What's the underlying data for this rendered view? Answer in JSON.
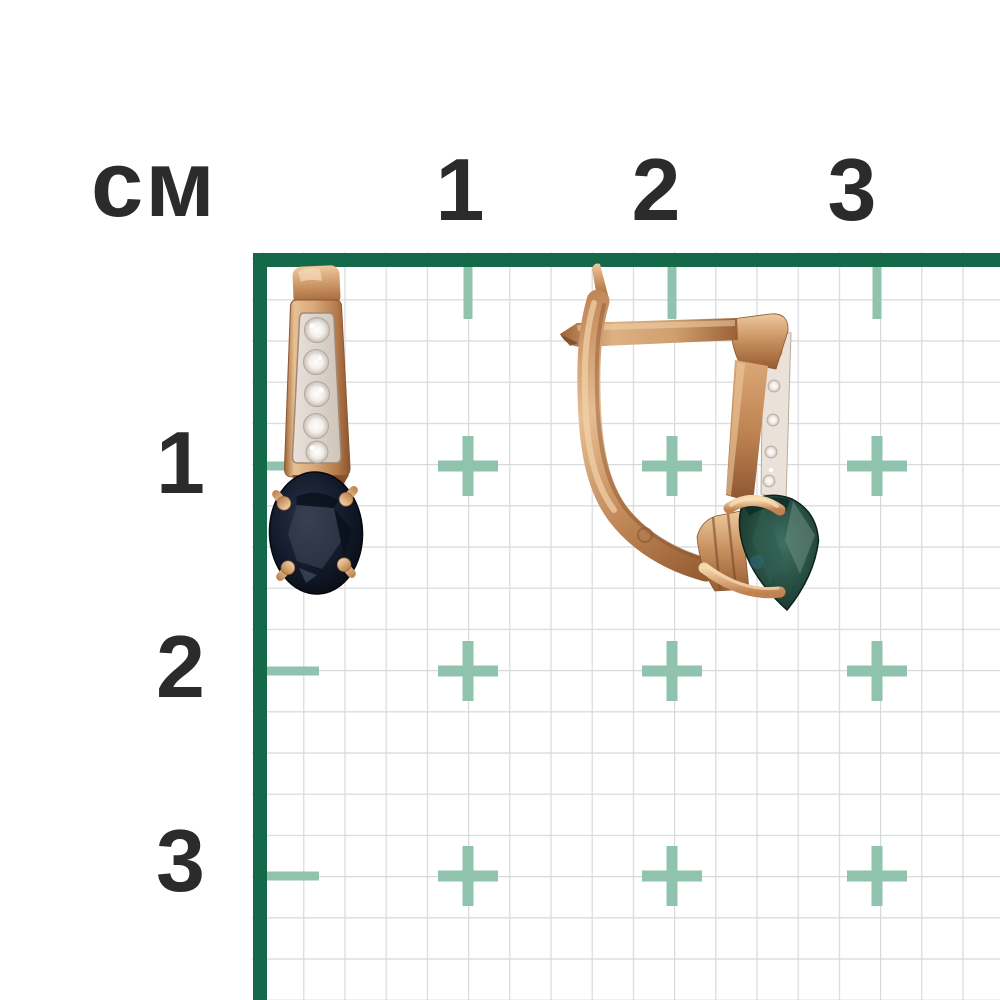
{
  "photo": {
    "description": "Pair of rose-gold earrings with dark sapphire stones and diamond pave photographed on a centimeter measurement grid"
  },
  "ruler": {
    "unit_label": "см",
    "top_tick_labels": [
      "1",
      "2",
      "3"
    ],
    "left_tick_labels": [
      "1",
      "2",
      "3"
    ]
  },
  "colors": {
    "background": "#FFFFFF",
    "label_ink": "#2B2B2C",
    "border_green": "#15694B",
    "cross_green": "#8FC3AD",
    "grid_line": "#D8D9DB",
    "gold_light": "#EFC99C",
    "gold_mid": "#C68E5D",
    "gold_dark": "#975D32",
    "stone_navy": "#121A2B",
    "stone_teal": "#24483C",
    "diamond_white": "#F2EEEA"
  }
}
